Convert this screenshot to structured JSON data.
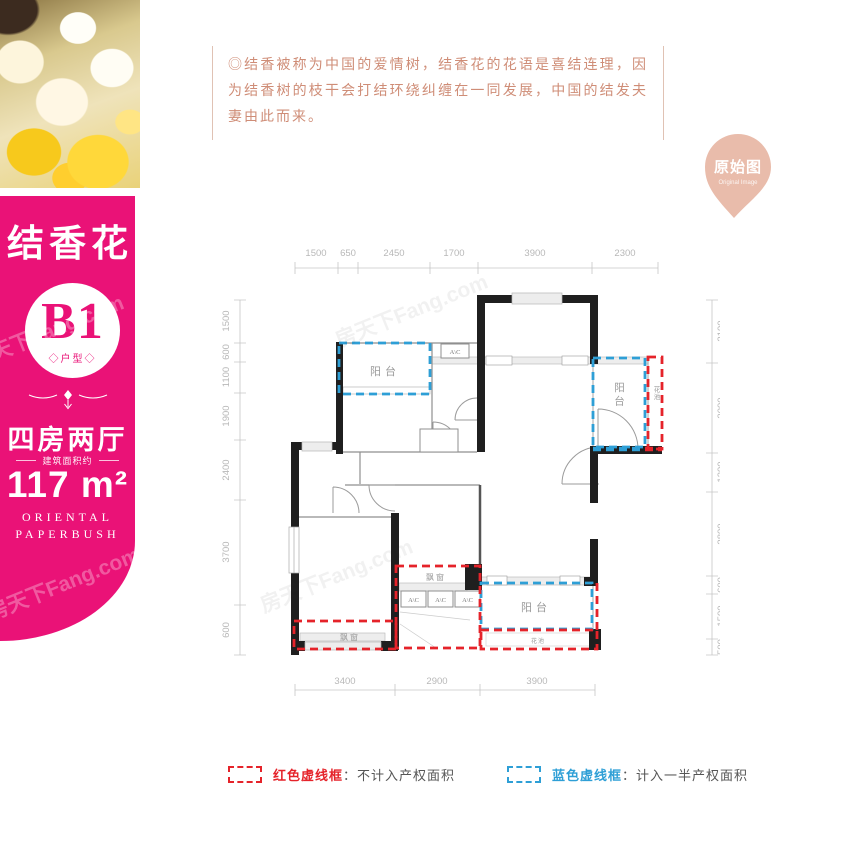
{
  "sidebar": {
    "flower_name": "结香花",
    "badge": "B1",
    "badge_sub": "◇户型◇",
    "layout_name": "四房两厅",
    "area_note": "建筑面积约",
    "area_value": "117 m²",
    "english_line1": "ORIENTAL",
    "english_line2": "PAPERBUSH"
  },
  "description": "◎结香被称为中国的爱情树，结香花的花语是喜结连理，因为结香树的枝干会打结环绕纠缠在一同发展，中国的结发夫妻由此而来。",
  "stamp": {
    "title": "原始图",
    "subtitle": "Original Image"
  },
  "watermark": "房天下Fang.com",
  "floorplan": {
    "labels": {
      "balcony": "阳台",
      "bay_window": "飘窗",
      "flower_bed": "花池",
      "ac": "A\\C"
    },
    "dimensions": {
      "top": [
        "1500",
        "650",
        "2450",
        "1700",
        "3900",
        "2300"
      ],
      "left": [
        "1500",
        "600",
        "1100",
        "1900",
        "2400",
        "3700",
        "600"
      ],
      "right": [
        "2100",
        "3000",
        "1300",
        "2800",
        "600",
        "1500",
        "500"
      ],
      "bottom": [
        "3400",
        "2900",
        "3900"
      ]
    }
  },
  "legend": {
    "red_label": "红色虚线框",
    "red_desc": "：不计入产权面积",
    "blue_label": "蓝色虚线框",
    "blue_desc": "：计入一半产权面积"
  },
  "colors": {
    "pink": "#ea1277",
    "red_dash": "#e5232a",
    "blue_dash": "#2e9fd6",
    "stamp": "#e9bcab",
    "desc_text": "#cf8d77"
  }
}
